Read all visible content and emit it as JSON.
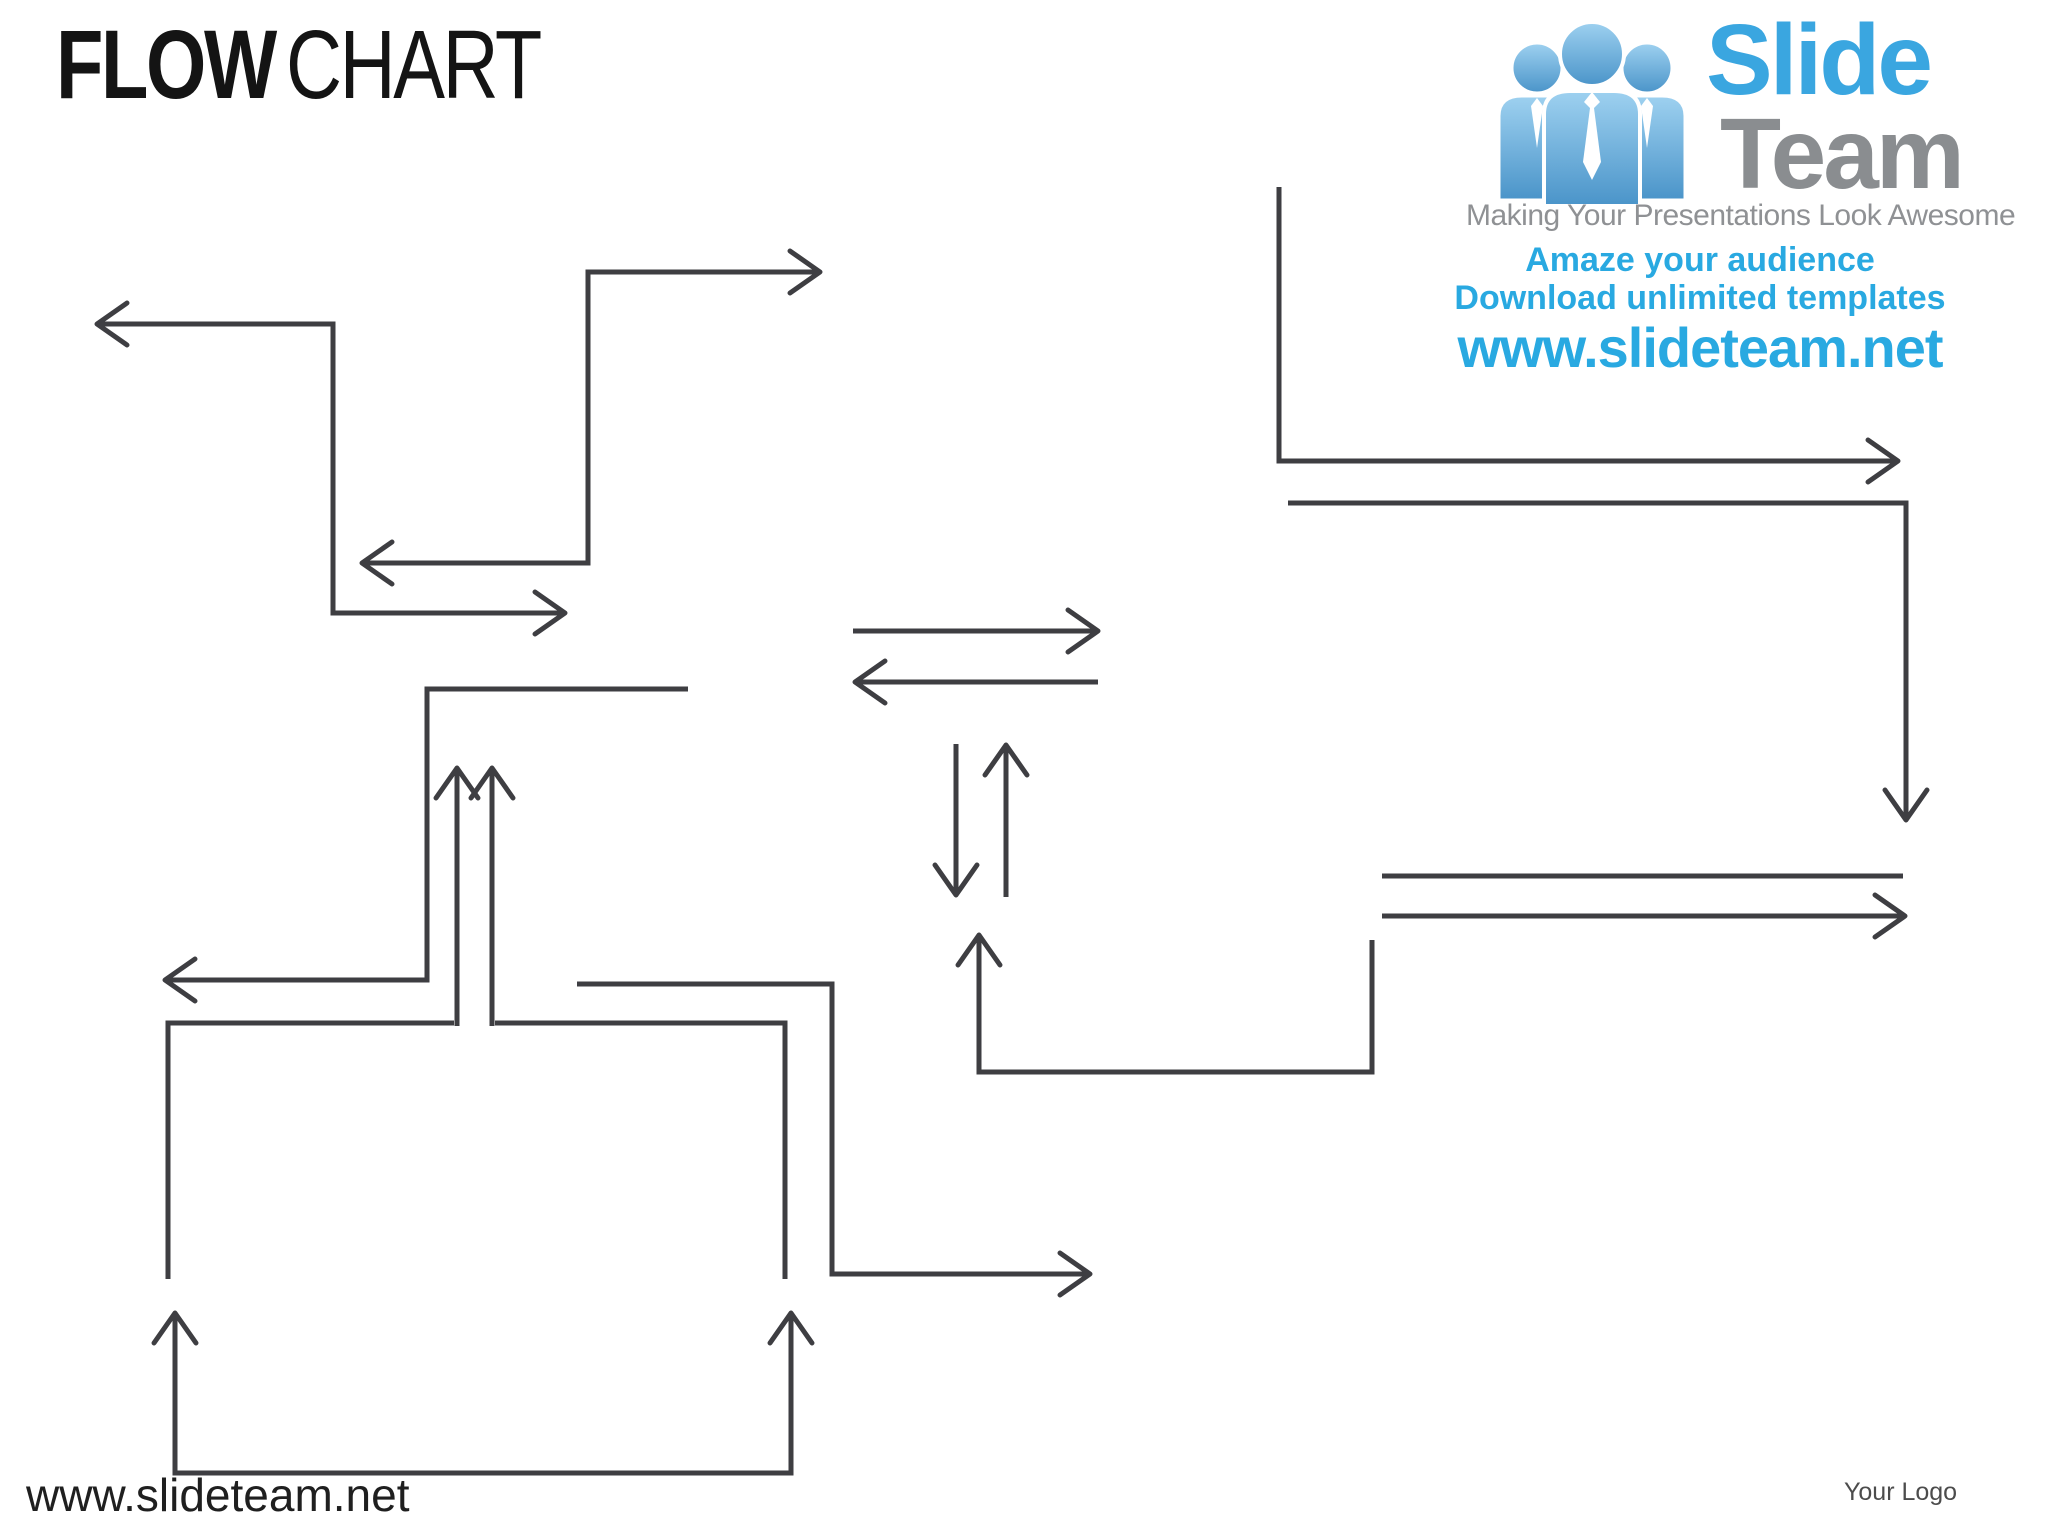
{
  "slide": {
    "background": "#ffffff"
  },
  "title": {
    "bold": "FLOW",
    "regular": "CHART",
    "color": "#141414"
  },
  "logo": {
    "people_icon": "three-people-with-ties",
    "brand_top": "Slide",
    "brand_bottom": "Team",
    "tagline": "Making Your Presentations Look Awesome",
    "promo_line1": "Amaze your audience",
    "promo_line2": "Download unlimited templates",
    "promo_url": "www.slideteam.net",
    "brand_blue": "#3aa6e0",
    "brand_gray": "#8a8d90",
    "tagline_gray": "#8f9194",
    "promo_blue": "#29a9e1"
  },
  "footer": {
    "site_url": "www.slideteam.net",
    "site_color": "#1f1f1f",
    "logo_placeholder": "Your Logo",
    "logo_placeholder_color": "#4c4c4c"
  },
  "diagram": {
    "stroke": "#3e3e42",
    "stroke_width": 5,
    "arrowhead": {
      "length": 30,
      "half_width": 21
    },
    "connectors": [
      {
        "id": "c1",
        "points": [
          [
            97,
            324
          ],
          [
            333,
            324
          ],
          [
            333,
            613
          ],
          [
            565,
            613
          ]
        ],
        "head_start": true,
        "head_end": true
      },
      {
        "id": "c2",
        "points": [
          [
            820,
            272
          ],
          [
            588,
            272
          ],
          [
            588,
            563
          ],
          [
            362,
            563
          ]
        ],
        "head_start": true,
        "head_end": true
      },
      {
        "id": "c3",
        "points": [
          [
            688,
            689
          ],
          [
            427,
            689
          ],
          [
            427,
            980
          ],
          [
            165,
            980
          ]
        ],
        "head_start": false,
        "head_end": true
      },
      {
        "id": "c4",
        "points": [
          [
            457,
            1026
          ],
          [
            457,
            768
          ]
        ],
        "head_start": false,
        "head_end": true
      },
      {
        "id": "c5",
        "points": [
          [
            492,
            1026
          ],
          [
            492,
            768
          ]
        ],
        "head_start": false,
        "head_end": true
      },
      {
        "id": "c6",
        "points": [
          [
            454,
            1023
          ],
          [
            168,
            1023
          ],
          [
            168,
            1279
          ]
        ],
        "head_start": false,
        "head_end": false
      },
      {
        "id": "c7",
        "points": [
          [
            495,
            1023
          ],
          [
            785,
            1023
          ],
          [
            785,
            1279
          ]
        ],
        "head_start": false,
        "head_end": false
      },
      {
        "id": "c8",
        "points": [
          [
            577,
            984
          ],
          [
            832,
            984
          ],
          [
            832,
            1274
          ],
          [
            1090,
            1274
          ]
        ],
        "head_start": false,
        "head_end": true
      },
      {
        "id": "c9",
        "points": [
          [
            175,
            1313
          ],
          [
            175,
            1473
          ],
          [
            791,
            1473
          ],
          [
            791,
            1313
          ]
        ],
        "head_start": true,
        "head_end": true
      },
      {
        "id": "c10",
        "points": [
          [
            853,
            631
          ],
          [
            1098,
            631
          ]
        ],
        "head_start": false,
        "head_end": true
      },
      {
        "id": "c11",
        "points": [
          [
            1098,
            682
          ],
          [
            855,
            682
          ]
        ],
        "head_start": false,
        "head_end": true
      },
      {
        "id": "c12",
        "points": [
          [
            956,
            744
          ],
          [
            956,
            895
          ]
        ],
        "head_start": false,
        "head_end": true
      },
      {
        "id": "c13",
        "points": [
          [
            1006,
            897
          ],
          [
            1006,
            745
          ]
        ],
        "head_start": false,
        "head_end": true
      },
      {
        "id": "c14",
        "points": [
          [
            1279,
            187
          ],
          [
            1279,
            461
          ],
          [
            1898,
            461
          ]
        ],
        "head_start": false,
        "head_end": true
      },
      {
        "id": "c15",
        "points": [
          [
            1288,
            503
          ],
          [
            1906,
            503
          ],
          [
            1906,
            820
          ]
        ],
        "head_start": false,
        "head_end": true
      },
      {
        "id": "c16",
        "points": [
          [
            1382,
            876
          ],
          [
            1903,
            876
          ]
        ],
        "head_start": false,
        "head_end": false
      },
      {
        "id": "c17",
        "points": [
          [
            1382,
            916
          ],
          [
            1905,
            916
          ]
        ],
        "head_start": false,
        "head_end": true
      },
      {
        "id": "c18",
        "points": [
          [
            1372,
            940
          ],
          [
            1372,
            1072
          ],
          [
            979,
            1072
          ],
          [
            979,
            935
          ]
        ],
        "head_start": false,
        "head_end": true
      }
    ]
  }
}
